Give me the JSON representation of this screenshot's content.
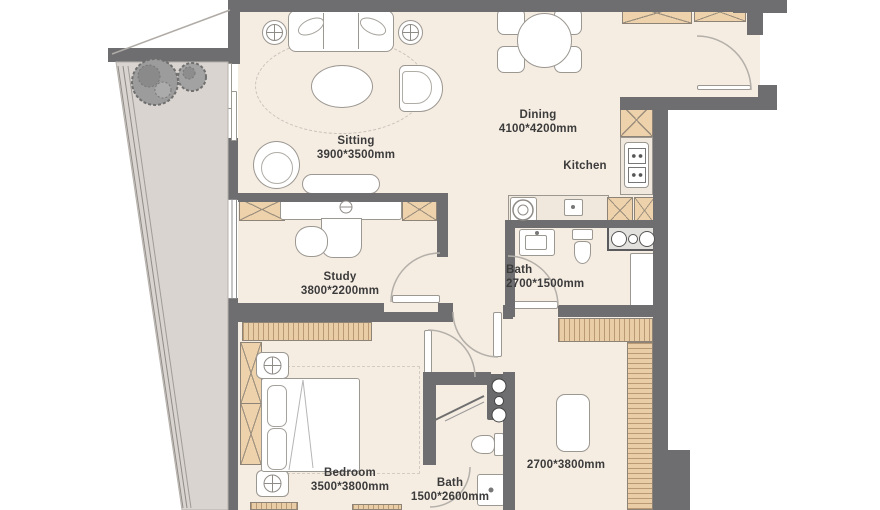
{
  "plan": {
    "rooms": {
      "sitting": {
        "name": "Sitting",
        "dims": "3900*3500mm"
      },
      "dining": {
        "name": "Dining",
        "dims": "4100*4200mm"
      },
      "kitchen": {
        "name": "Kitchen"
      },
      "study": {
        "name": "Study",
        "dims": "3800*2200mm"
      },
      "bath_upper": {
        "name": "Bath",
        "dims": "2700*1500mm"
      },
      "bedroom": {
        "name": "Bedroom",
        "dims": "3500*3800mm"
      },
      "bath_lower": {
        "name": "Bath",
        "dims": "1500*2600mm"
      },
      "bedroom2": {
        "dims": "2700*3800mm"
      }
    },
    "colors": {
      "wall": "#6e6e70",
      "floor": "#f5ece2",
      "balcony": "#d9d4cf",
      "wood": "#eed2ab",
      "wood_light": "#e9cda6",
      "text": "#3b3b3b"
    }
  }
}
